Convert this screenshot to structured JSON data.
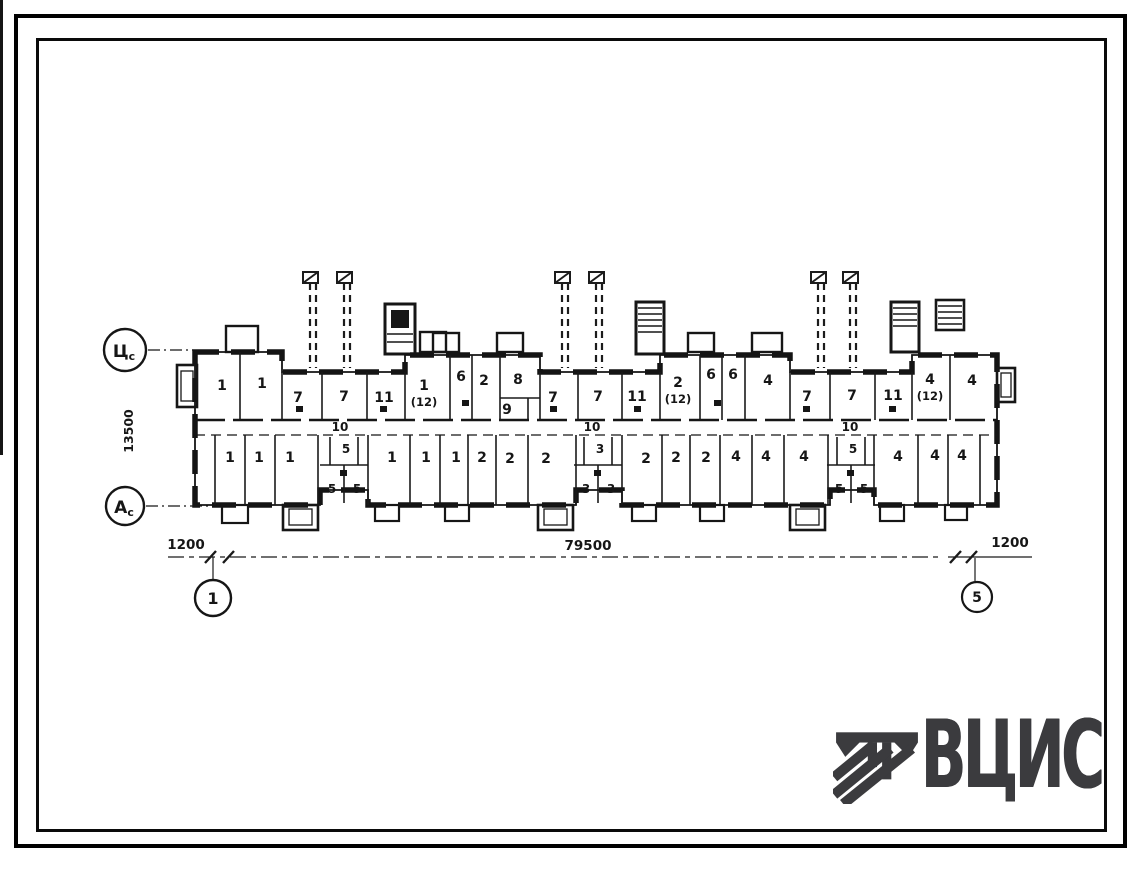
{
  "logo": {
    "text": "ВЦИС",
    "color": "#3b3b3e",
    "emblem": "column-with-diagonal-stripes-icon"
  },
  "axis_markers": {
    "left_top": "Цс",
    "left_bottom": "Ас",
    "bottom_left": "1",
    "bottom_right": "5"
  },
  "dimensions": {
    "left_setback": "1200",
    "overall_length": "79500",
    "right_setback": "1200",
    "building_depth": "13500"
  },
  "plan": {
    "corridor_labels": [
      {
        "text": "10",
        "x": 340,
        "y": 431
      },
      {
        "text": "10",
        "x": 592,
        "y": 431
      },
      {
        "text": "10",
        "x": 850,
        "y": 431
      }
    ],
    "rooms_top": [
      {
        "label": "1",
        "x": 222,
        "y": 390
      },
      {
        "label": "1",
        "x": 262,
        "y": 388
      },
      {
        "label": "7",
        "x": 298,
        "y": 402
      },
      {
        "label": "7",
        "x": 344,
        "y": 401
      },
      {
        "label": "11",
        "x": 384,
        "y": 402
      },
      {
        "label": "1",
        "sub": "(12)",
        "x": 424,
        "y": 390
      },
      {
        "label": "6",
        "x": 461,
        "y": 381
      },
      {
        "label": "2",
        "x": 484,
        "y": 385
      },
      {
        "label": "8",
        "x": 518,
        "y": 384
      },
      {
        "label": "9",
        "x": 507,
        "y": 414
      },
      {
        "label": "7",
        "x": 553,
        "y": 402
      },
      {
        "label": "7",
        "x": 598,
        "y": 401
      },
      {
        "label": "11",
        "x": 637,
        "y": 401
      },
      {
        "label": "2",
        "sub": "(12)",
        "x": 678,
        "y": 387
      },
      {
        "label": "6",
        "x": 711,
        "y": 379
      },
      {
        "label": "6",
        "x": 733,
        "y": 379
      },
      {
        "label": "4",
        "x": 768,
        "y": 385
      },
      {
        "label": "7",
        "x": 807,
        "y": 401
      },
      {
        "label": "7",
        "x": 852,
        "y": 400
      },
      {
        "label": "11",
        "x": 893,
        "y": 400
      },
      {
        "label": "4",
        "sub": "(12)",
        "x": 930,
        "y": 384
      },
      {
        "label": "4",
        "x": 972,
        "y": 385
      }
    ],
    "rooms_bottom": [
      {
        "label": "1",
        "x": 230,
        "y": 462
      },
      {
        "label": "1",
        "x": 259,
        "y": 462
      },
      {
        "label": "1",
        "x": 290,
        "y": 462
      },
      {
        "label": "1",
        "x": 392,
        "y": 462
      },
      {
        "label": "1",
        "x": 426,
        "y": 462
      },
      {
        "label": "1",
        "x": 456,
        "y": 462
      },
      {
        "label": "2",
        "x": 482,
        "y": 462
      },
      {
        "label": "2",
        "x": 510,
        "y": 463
      },
      {
        "label": "2",
        "x": 546,
        "y": 463
      },
      {
        "label": "2",
        "x": 646,
        "y": 463
      },
      {
        "label": "2",
        "x": 676,
        "y": 462
      },
      {
        "label": "2",
        "x": 706,
        "y": 462
      },
      {
        "label": "4",
        "x": 736,
        "y": 461
      },
      {
        "label": "4",
        "x": 766,
        "y": 461
      },
      {
        "label": "4",
        "x": 804,
        "y": 461
      },
      {
        "label": "4",
        "x": 898,
        "y": 461
      },
      {
        "label": "4",
        "x": 935,
        "y": 460
      },
      {
        "label": "4",
        "x": 962,
        "y": 460
      }
    ],
    "stacked_units": [
      {
        "x": 344,
        "top": "5",
        "left": "5",
        "right": "5"
      },
      {
        "x": 598,
        "top": "3",
        "left": "3",
        "right": "3"
      },
      {
        "x": 851,
        "top": "5",
        "left": "5",
        "right": "5"
      }
    ]
  }
}
